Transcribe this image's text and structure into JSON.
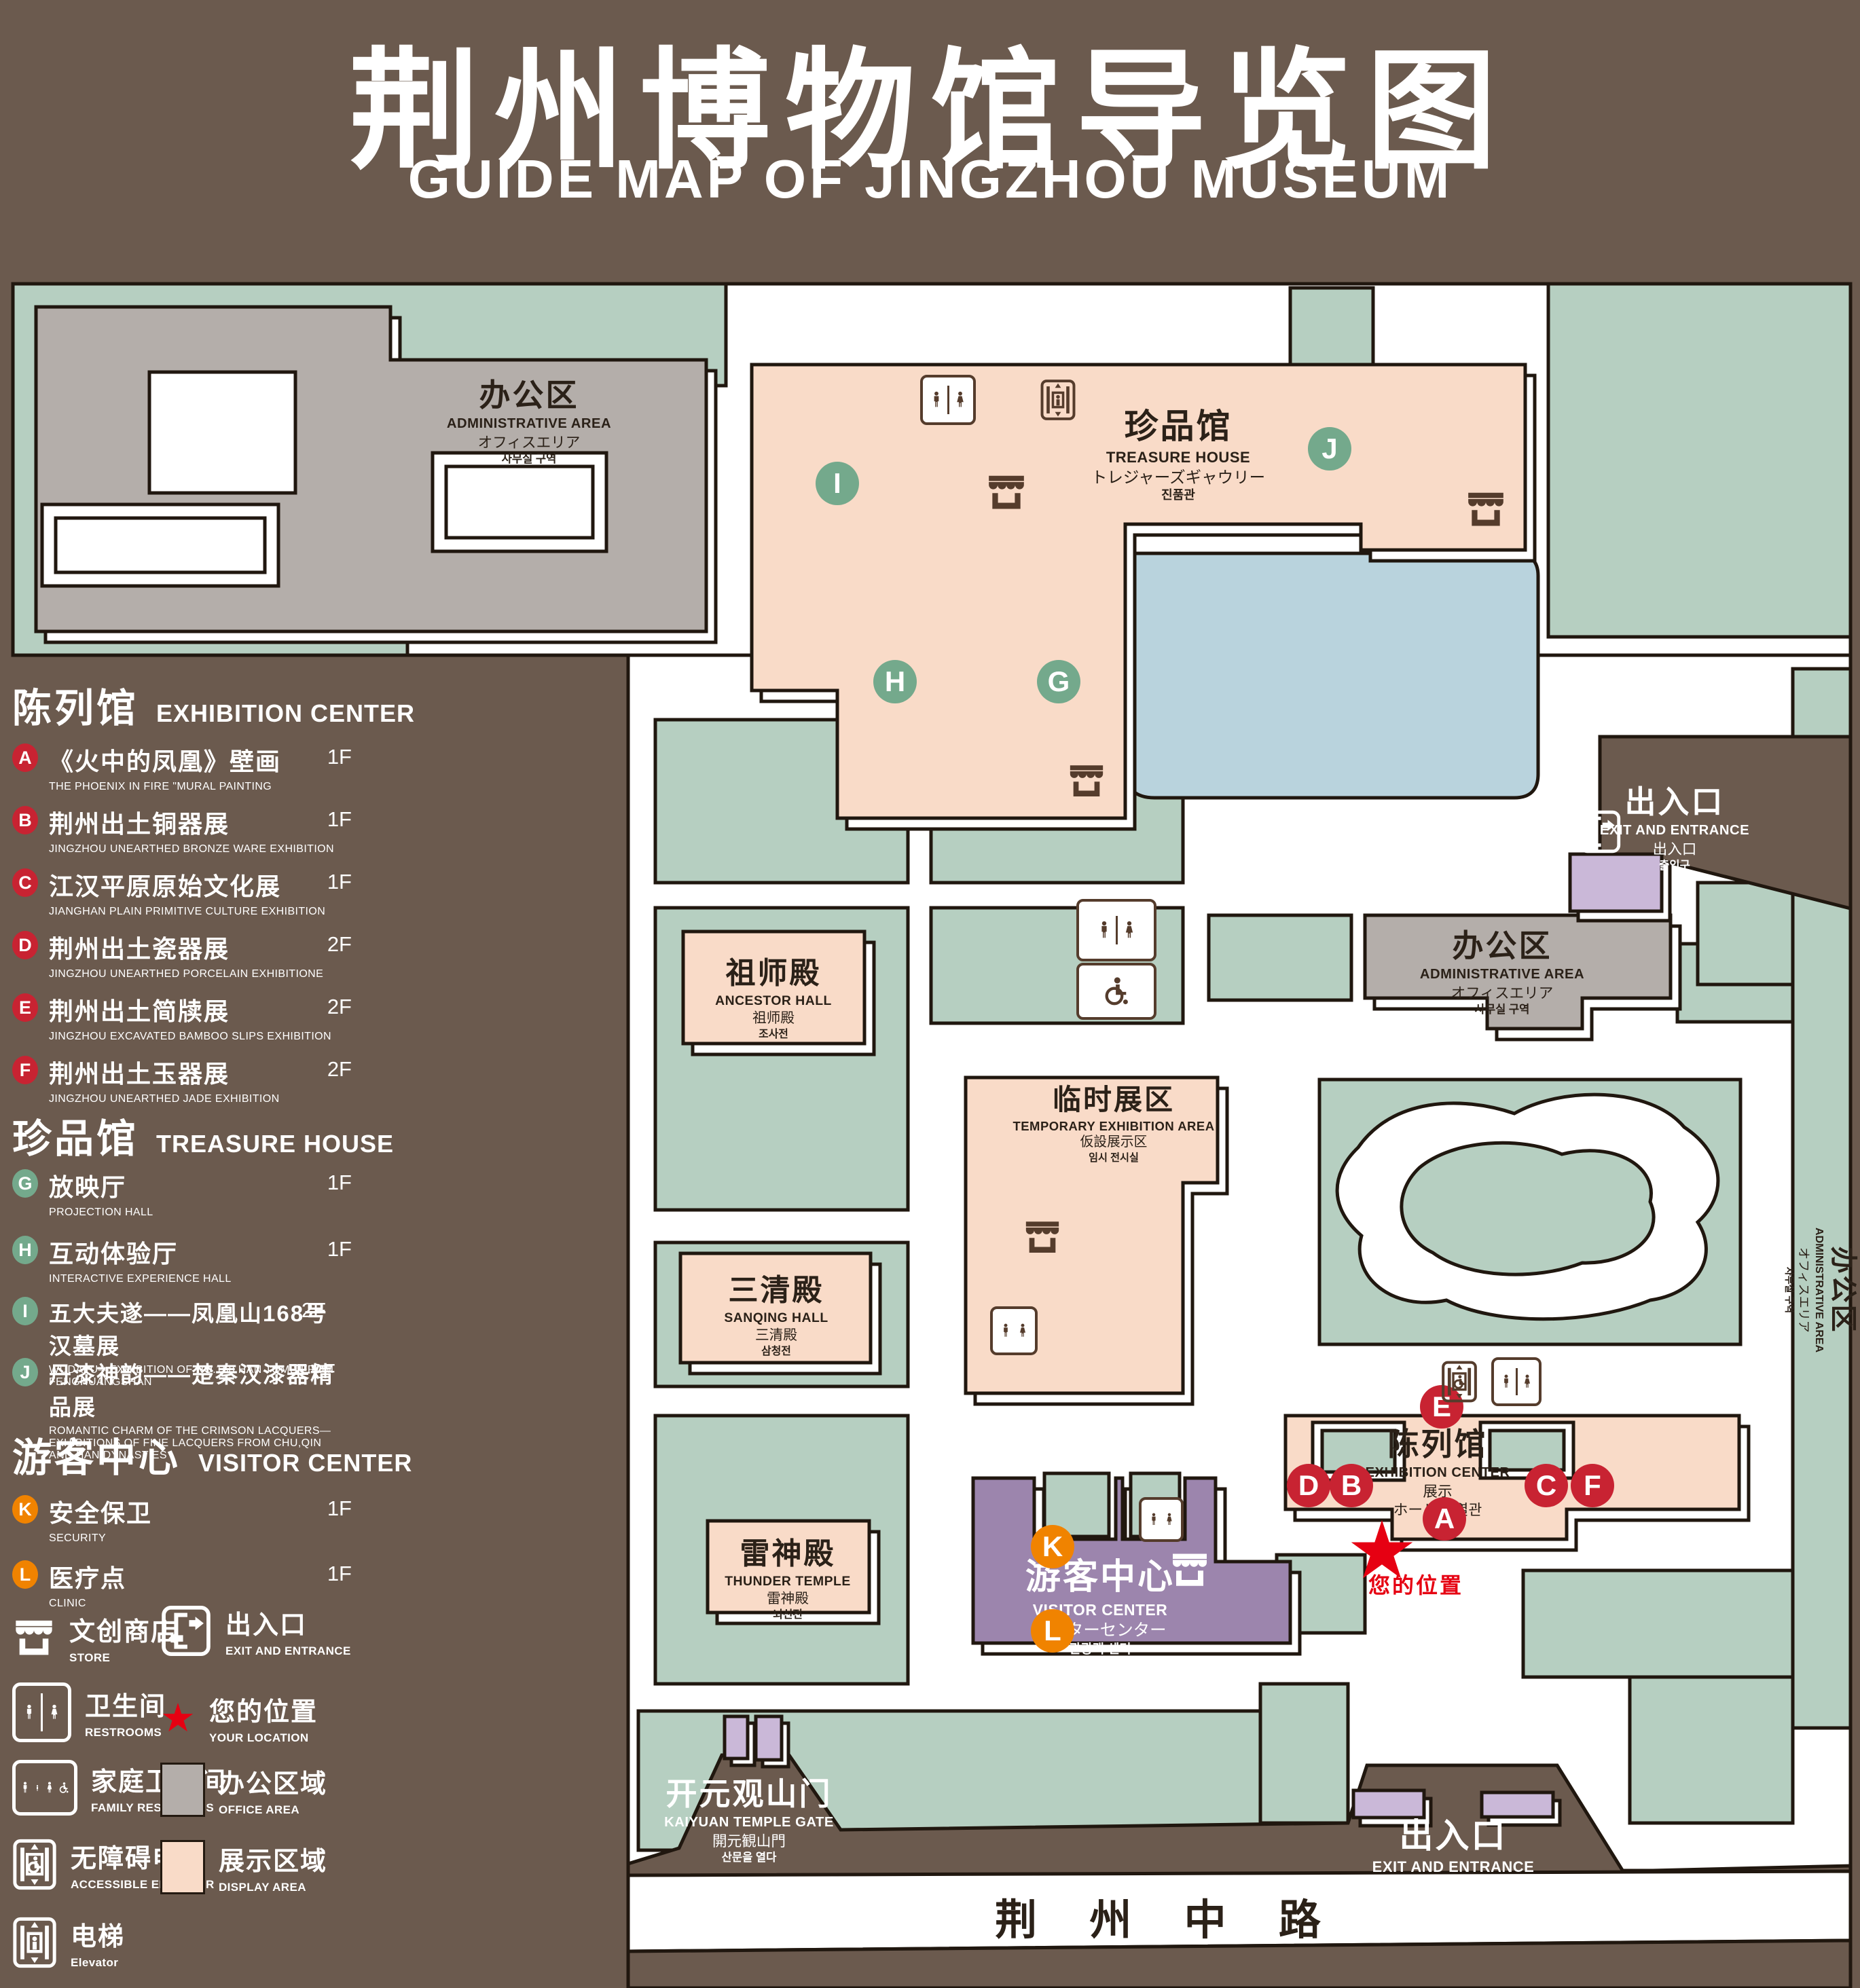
{
  "title": {
    "zh": "荆州博物馆导览图",
    "en": "GUIDE MAP OF JINGZHOU MUSEUM"
  },
  "colors": {
    "background": "#6b5a4e",
    "lawn_green": "#b6cfc1",
    "display_area": "#f9dbc8",
    "office_area": "#b4aeaa",
    "water": "#b9d3dd",
    "visitor_purple": "#9c85ad",
    "light_purple": "#cab8d8",
    "badge_red": "#c82332",
    "badge_green": "#74a98c",
    "badge_orange": "#f08300",
    "location_red": "#e60012",
    "outline": "#20170f"
  },
  "legend": {
    "sections": [
      {
        "title_zh": "陈列馆",
        "title_en": "EXHIBITION CENTER",
        "badge_color": "red",
        "items": [
          {
            "letter": "A",
            "zh": "《火中的凤凰》壁画",
            "en": "THE PHOENIX IN FIRE \"MURAL PAINTING",
            "floor": "1F"
          },
          {
            "letter": "B",
            "zh": "荆州出土铜器展",
            "en": "JINGZHOU UNEARTHED BRONZE WARE EXHIBITION",
            "floor": "1F"
          },
          {
            "letter": "C",
            "zh": "江汉平原原始文化展",
            "en": "JIANGHAN PLAIN PRIMITIVE CULTURE EXHIBITION",
            "floor": "1F"
          },
          {
            "letter": "D",
            "zh": "荆州出土瓷器展",
            "en": "JINGZHOU UNEARTHED PORCELAIN EXHIBITIONE",
            "floor": "2F"
          },
          {
            "letter": "E",
            "zh": "荆州出土简牍展",
            "en": "JINGZHOU EXCAVATED BAMBOO SLIPS EXHIBITION",
            "floor": "2F"
          },
          {
            "letter": "F",
            "zh": "荆州出土玉器展",
            "en": "JINGZHOU UNEARTHED JADE EXHIBITION",
            "floor": "2F"
          }
        ]
      },
      {
        "title_zh": "珍品馆",
        "title_en": "TREASURE HOUSE",
        "badge_color": "green",
        "items": [
          {
            "letter": "G",
            "zh": "放映厅",
            "en": "PROJECTION HALL",
            "floor": "1F"
          },
          {
            "letter": "H",
            "zh": "互动体验厅",
            "en": "INTERACTIVE EXPERIENCE HALL",
            "floor": "1F"
          },
          {
            "letter": "I",
            "zh": "五大夫遂——凤凰山168号汉墓展",
            "en": "WUDAFU—EXHIBITION OF NO.168 HAN TOMB FROM FENGHUANGSHAN",
            "floor": "2F"
          },
          {
            "letter": "J",
            "zh": "丹漆神韵——楚秦汉漆器精品展",
            "en": "ROMANTIC CHARM OF THE CRIMSON LACQUERS—EXHIBITIONS OF FINE LACQUERS FROM CHU,QIN AND HAN DYNASTIES",
            "floor": "1-2F"
          }
        ]
      },
      {
        "title_zh": "游客中心",
        "title_en": "VISITOR CENTER",
        "badge_color": "orange",
        "items": [
          {
            "letter": "K",
            "zh": "安全保卫",
            "en": "SECURITY",
            "floor": "1F"
          },
          {
            "letter": "L",
            "zh": "医疗点",
            "en": "CLINIC",
            "floor": "1F"
          }
        ]
      }
    ],
    "symbols": [
      {
        "icon": "store-icon",
        "zh": "文创商店",
        "en": "STORE"
      },
      {
        "icon": "exit-icon",
        "zh": "出入口",
        "en": "EXIT AND ENTRANCE"
      },
      {
        "icon": "restrooms-icon",
        "zh": "卫生间",
        "en": "RESTROOMS"
      },
      {
        "icon": "location-star-icon",
        "zh": "您的位置",
        "en": "YOUR LOCATION"
      },
      {
        "icon": "family-restrooms-icon",
        "zh": "家庭卫生间",
        "en": "FAMILY RESTROOMS"
      },
      {
        "icon": "office-area-swatch",
        "zh": "办公区域",
        "en": "OFFICE AREA"
      },
      {
        "icon": "accessible-elevator-icon",
        "zh": "无障碍电梯",
        "en": "ACCESSIBLE ELEVATOR"
      },
      {
        "icon": "display-area-swatch",
        "zh": "展示区域",
        "en": "DISPLAY AREA"
      },
      {
        "icon": "elevator-icon",
        "zh": "电梯",
        "en": "Elevator"
      }
    ]
  },
  "map": {
    "admin_nw": {
      "zh": "办公区",
      "en": "ADMINISTRATIVE AREA",
      "ja": "オフィスエリア",
      "ko": "사무실 구역"
    },
    "treasure_house": {
      "zh": "珍品馆",
      "en": "TREASURE HOUSE",
      "ja": "トレジャーズギャウリー",
      "ko": "진품관"
    },
    "ancestor_hall": {
      "zh": "祖师殿",
      "en": "ANCESTOR HALL",
      "ja": "祖师殿",
      "ko": "조사전"
    },
    "temporary_area": {
      "zh": "临时展区",
      "en": "TEMPORARY EXHIBITION AREA",
      "ja": "仮設展示区",
      "ko": "임시 전시실"
    },
    "admin_east": {
      "zh": "办公区",
      "en": "ADMINISTRATIVE AREA",
      "ja": "オフィスエリア",
      "ko": "사무실 구역"
    },
    "admin_right_strip": {
      "zh": "办公区",
      "en": "ADMINISTRATIVE AREA",
      "ja": "オフィスエリア",
      "ko": "사무실 구역"
    },
    "sanqing_hall": {
      "zh": "三清殿",
      "en": "SANQING HALL",
      "ja": "三清殿",
      "ko": "삼청전"
    },
    "thunder_temple": {
      "zh": "雷神殿",
      "en": "THUNDER TEMPLE",
      "ja": "雷神殿",
      "ko": "뇌신전"
    },
    "visitor_center": {
      "zh": "游客中心",
      "en": "VISITOR CENTER",
      "ja": "ビジターセンター",
      "ko": "관광객 센터"
    },
    "exhibition_center": {
      "zh": "陈列馆",
      "en": "EXHIBITION CENTER",
      "ja": "展示",
      "ja2": "ホール 진열관"
    },
    "gate": {
      "zh": "开元观山门",
      "en": "KAIYUAN TEMPLE GATE",
      "ja": "開元観山門",
      "ko": "산문을 열다"
    },
    "exit_east": {
      "zh": "出入口",
      "en": "EXIT AND ENTRANCE",
      "zh2": "出入口",
      "ko": "출입구"
    },
    "exit_south": {
      "zh": "出入口",
      "en": "EXIT AND ENTRANCE",
      "zh2": "出入口",
      "ko": "출입구"
    },
    "your_location": "您的位置",
    "road": "荆 州 中 路",
    "badges": {
      "I": "I",
      "J": "J",
      "H": "H",
      "G": "G",
      "E": "E",
      "D": "D",
      "B": "B",
      "C": "C",
      "F": "F",
      "A": "A",
      "K": "K",
      "L": "L"
    }
  }
}
